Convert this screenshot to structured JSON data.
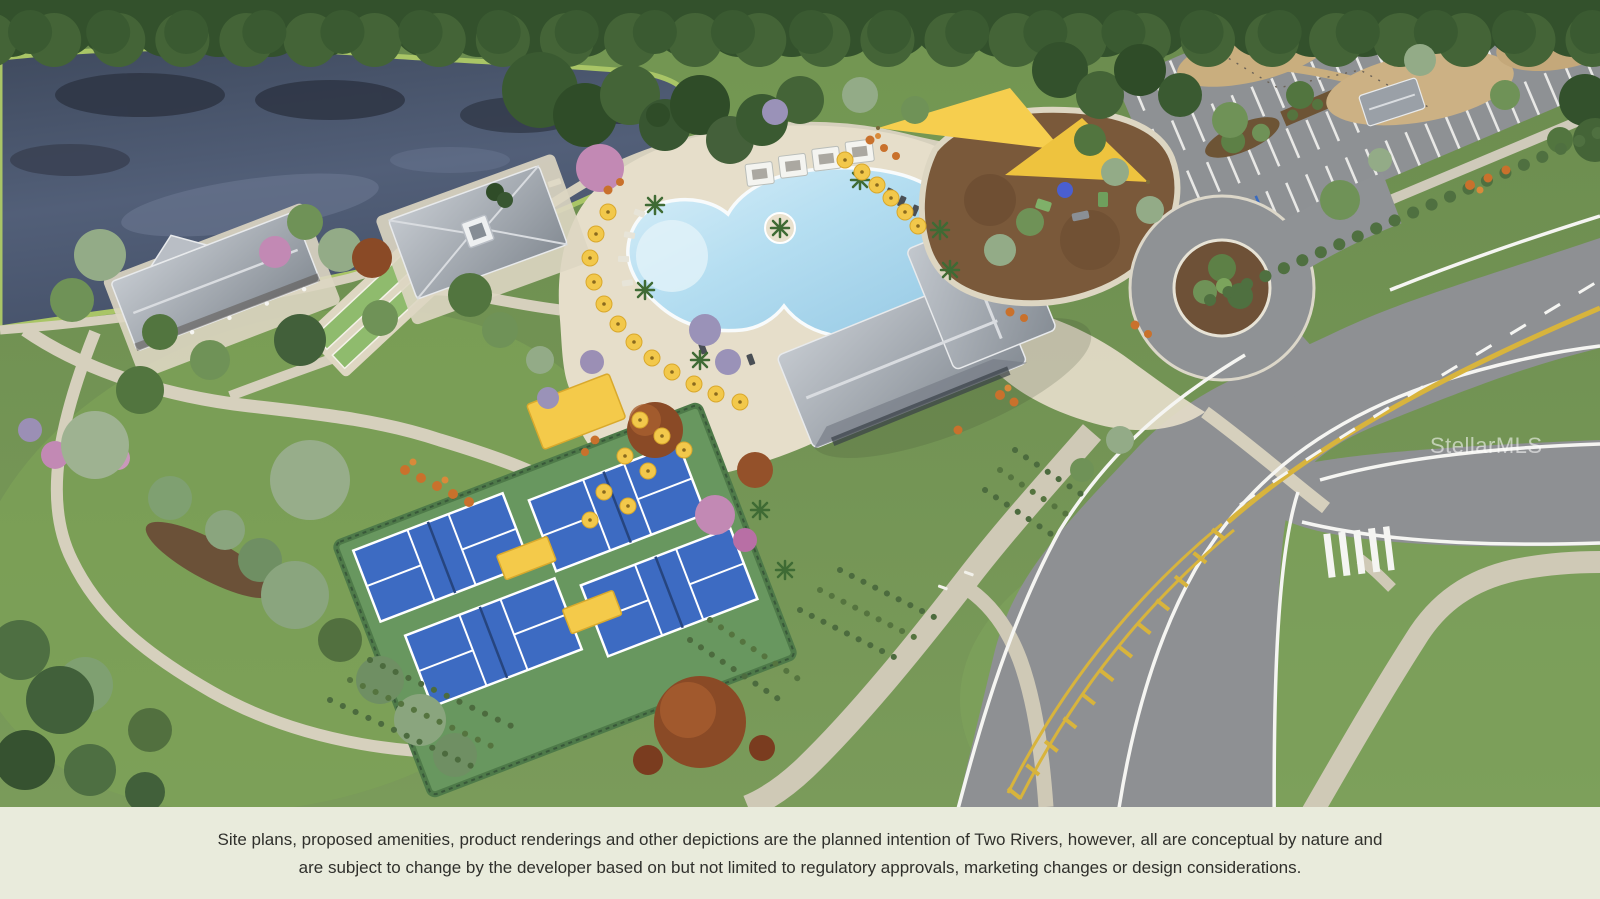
{
  "watermark": {
    "text": "StellarMLS"
  },
  "caption": {
    "line1": "Site plans, proposed amenities, product renderings and other depictions are the planned intention of Two Rivers, however, all are conceptual by nature and",
    "line2": "are subject to change by the developer based on but not limited to regulatory approvals, marketing changes or design considerations.",
    "background": "#e9ebdc",
    "text_color": "#30302c"
  },
  "scene": {
    "type": "aerial-site-plan-rendering",
    "community_name": "Two Rivers",
    "features": [
      "pond-with-tree-reflections",
      "resort-style-lagoon-pool",
      "pool-cabanas",
      "yellow-pool-umbrellas",
      "clubhouse-gray-roof",
      "lakeside-pavilion",
      "event-lawn-pavilion",
      "bocce-lanes",
      "pickleball-courts",
      "shade-canopies",
      "playground-with-shade-sails",
      "drop-off-roundabout",
      "parking-lot",
      "main-road-with-yellow-median",
      "crosswalk",
      "walking-trails",
      "event-lawn",
      "dog-park-trails"
    ],
    "palette": {
      "grass": "#74954f",
      "forest": "#33512c",
      "lake": "#4d596f",
      "pool_water": "#aed9ee",
      "deck": "#e6deca",
      "path": "#cfc9b6",
      "asphalt": "#8e9093",
      "roof_gray": "#a7adb4",
      "umbrella_yellow": "#f2c84b",
      "court_blue": "#3d6bc2",
      "court_green": "#68975f",
      "mulch_brown": "#7a593a",
      "road_yellow": "#d8b43c",
      "flower_orange": "#c9712c",
      "flower_pink": "#c289b4"
    }
  }
}
